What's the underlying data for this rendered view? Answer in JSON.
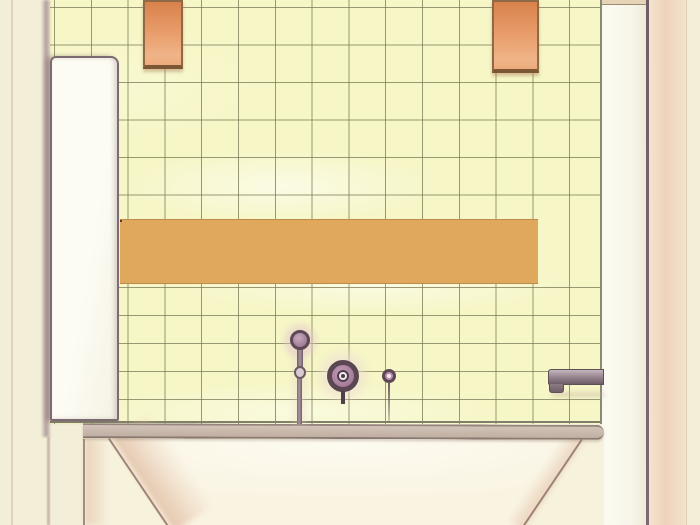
{
  "scene": {
    "title": "bathroom-elevation-sketch",
    "medium": "hand-drawn watercolor and pencil elevation",
    "elements": {
      "wall": "pale yellow square ceramic tile field",
      "accent_band": "two-row terracotta basketweave mosaic band",
      "pendant_blocks": "two terracotta blocks at ceiling line",
      "left_panel": "white side wall panel",
      "fixtures": [
        "hand-shower on slide rod",
        "round mixer valve",
        "small diverter knob",
        "wall-mounted tub spout"
      ],
      "bathtub": "built-in bathtub with sloped apron opening"
    }
  },
  "palette": {
    "paper_cream": "#f3eed8",
    "tile_yellow": "#f6f6c6",
    "grid_line_olive": "#78785a",
    "panel_white": "#fcfbf2",
    "terracotta_dark": "#d8824b",
    "terracotta_light": "#f0b488",
    "mosaic_mortar": "#dfa85c",
    "rim_beige": "#c9bab0",
    "metal_dark_plum": "#5a4752",
    "metal_plum": "#b88fac",
    "shade_pink": "#dcb49a",
    "right_margin_pink": "#eed2bb"
  },
  "mosaic": {
    "rows": 2,
    "cols": 13,
    "gap_color": "rgba(226,166,92,0.6)",
    "stripe_pairs": [
      [
        "#93303a",
        "#dd7d3d"
      ],
      [
        "#c23b33",
        "#8e4a62"
      ],
      [
        "#7c2f45",
        "#d97b3a"
      ],
      [
        "#bf4435",
        "#93303a"
      ],
      [
        "#8e4a62",
        "#dd7d3d"
      ],
      [
        "#a03343",
        "#c9663a"
      ]
    ]
  }
}
